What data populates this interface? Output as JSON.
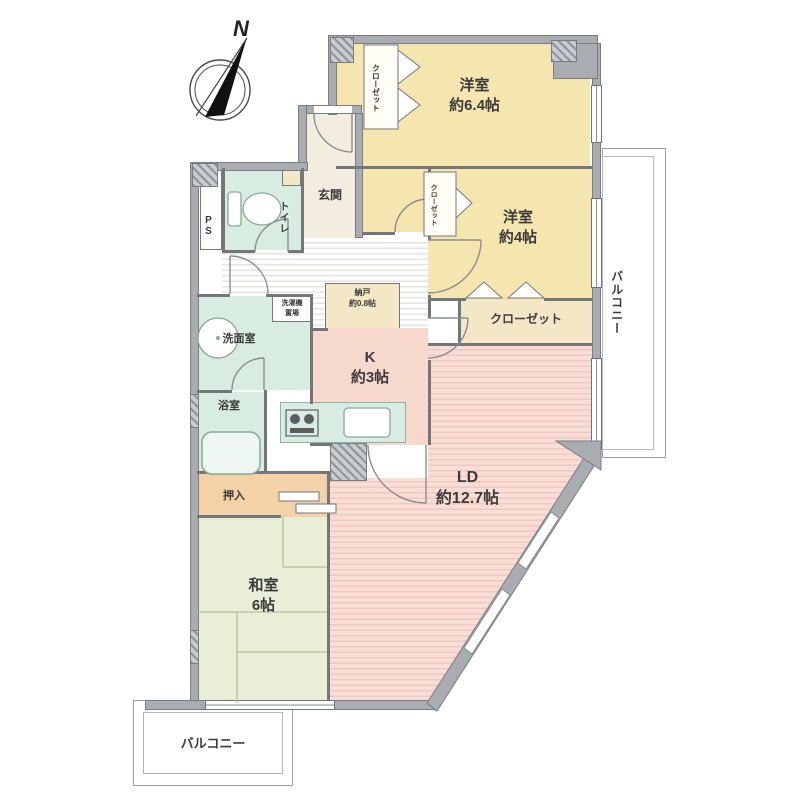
{
  "compass": {
    "label": "N"
  },
  "rooms": {
    "western_64": {
      "name": "洋室",
      "size": "約6.4帖"
    },
    "western_4": {
      "name": "洋室",
      "size": "約4帖"
    },
    "living_dining": {
      "name": "LD",
      "size": "約12.7帖"
    },
    "kitchen": {
      "name": "K",
      "size": "約3帖"
    },
    "japanese": {
      "name": "和室",
      "size": "6帖"
    },
    "storeroom": {
      "name": "納戸",
      "size": "約0.8帖"
    },
    "oshiire": {
      "name": "押入"
    },
    "entrance": {
      "name": "玄関"
    },
    "toilet": {
      "name": "トイレ"
    },
    "pipe_space": {
      "name": "PS"
    },
    "washroom": {
      "name": "洗面室"
    },
    "laundry": {
      "line1": "洗濯機",
      "line2": "置場"
    },
    "bathroom": {
      "name": "浴室"
    },
    "closet_hall": {
      "name": "クローゼット"
    },
    "closet_west64": {
      "name": "クローゼット"
    },
    "closet_west4": {
      "name": "クローゼット"
    },
    "balcony_east": {
      "name": "バルコニー"
    },
    "balcony_south": {
      "name": "バルコニー"
    }
  },
  "colors": {
    "wall": "#a9adb2",
    "western_room": "#f5e5ae",
    "ld_kitchen": "#f6d8cd",
    "japanese_room": "#e9efd6",
    "wet_area": "#d8ece2",
    "closet_beige": "#f4e7c6",
    "oshiire_orange": "#f2d2a6",
    "hall_stripe": "#e3e3e1"
  }
}
